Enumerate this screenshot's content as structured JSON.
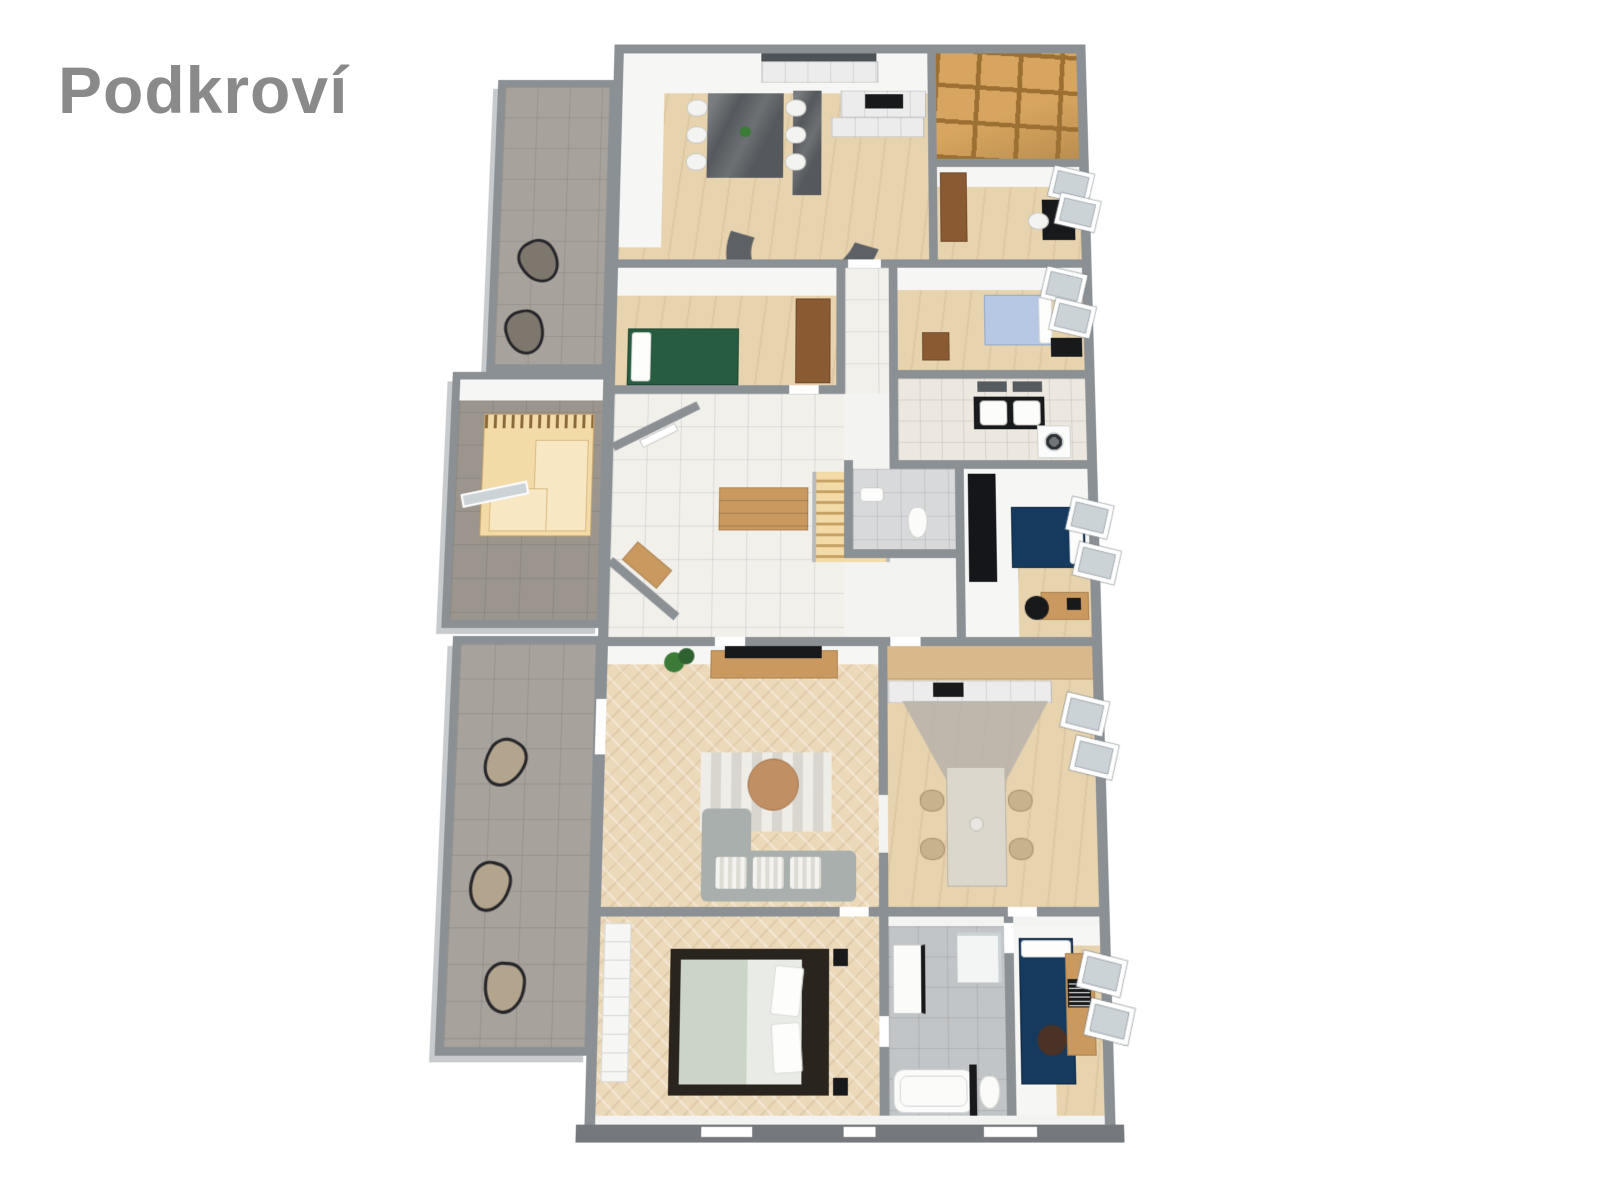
{
  "title": {
    "text": "Podkroví"
  },
  "canvas": {
    "width": 1599,
    "height": 1200,
    "background": "#ffffff"
  },
  "colors": {
    "white": "#ffffff",
    "titleGrey": "#8a8a8a",
    "wall": "#8b9094",
    "wallDark": "#75797d",
    "wallLight": "#c8cbcd",
    "wallFace": "#f6f6f4",
    "wood": "#e7d3ae",
    "herringbone": "#ecd9ba",
    "tileGrey": "#a7a29b",
    "tileWarm": "#9b958d",
    "tileWhite": "#f2f0eb",
    "tileBeige": "#ece7df",
    "tileBath": "#c2c5c7",
    "attic": "#d7a55f",
    "atticBeam": "#9c6f33",
    "stoneDark": "#55595d",
    "cabinet": "#ececec",
    "sofaDark": "#5d6165",
    "sofaGrey": "#a9afac",
    "bedGreen": "#275c41",
    "bedBlue": "#16395e",
    "bedLightBlue": "#b6c8e4",
    "mattress": "#e9ece6",
    "sage": "#cbd4c6",
    "bedFrameDark": "#2a241e",
    "furnWood": "#c9995f",
    "brownWood": "#8a5a33",
    "tanChair": "#c7b28c",
    "stairWood": "#f3dba8",
    "rugLight": "#efede8",
    "rugStripe": "#d9d6cf",
    "plant": "#3c7a38",
    "black": "#17191b",
    "glass": "#ccd3d7",
    "loungeDark": "#7d776e",
    "loungeTan": "#b2a48d",
    "travertine": "#dcd7cc"
  },
  "floorplan": {
    "type": "3d-floor-plan-render",
    "areas": [
      {
        "id": "upper-terrace",
        "floor": "grey-tile",
        "furniture": [
          "lounge-chair",
          "lounge-chair"
        ]
      },
      {
        "id": "dining-kitchen",
        "floor": "light-wood",
        "furniture": [
          "kitchen-cabinets",
          "cooktop",
          "dark-stone-island",
          "dining-table",
          "six-white-chairs",
          "curved-sofa"
        ]
      },
      {
        "id": "attic-storage",
        "floor": "exposed-wood-joists",
        "furniture": []
      },
      {
        "id": "study-bedroom",
        "floor": "light-wood",
        "furniture": [
          "wardrobe",
          "desk",
          "chair",
          "roof-window",
          "roof-window"
        ]
      },
      {
        "id": "green-bedroom",
        "floor": "light-wood",
        "furniture": [
          "double-bed-green",
          "wardrobe"
        ]
      },
      {
        "id": "hallway-stairs",
        "floor": "white-tile",
        "furniture": [
          "staircase",
          "chest-of-drawers",
          "entry-door",
          "shoe-cabinet"
        ]
      },
      {
        "id": "blue-bedroom-small",
        "floor": "light-wood",
        "furniture": [
          "bed-light-blue",
          "dresser",
          "desk",
          "roof-window",
          "roof-window"
        ]
      },
      {
        "id": "bathroom-upper",
        "floor": "beige-tile",
        "furniture": [
          "double-washbasin-vanity",
          "mirrors",
          "washing-machine"
        ]
      },
      {
        "id": "wc",
        "floor": "grey-tile",
        "furniture": [
          "toilet",
          "washbasin"
        ]
      },
      {
        "id": "blue-bedroom-mid",
        "floor": "white-low-ceiling",
        "furniture": [
          "double-bed-blue",
          "black-wardrobe",
          "desk",
          "chair",
          "laptop",
          "roof-window",
          "roof-window"
        ]
      },
      {
        "id": "sauna-room",
        "floor": "grey-tile",
        "furniture": [
          "sauna-cabin",
          "glass-door"
        ]
      },
      {
        "id": "living-room",
        "floor": "herringbone-wood",
        "furniture": [
          "tv-sideboard",
          "tv",
          "plant",
          "striped-rug",
          "round-coffee-table",
          "corner-sofa"
        ]
      },
      {
        "id": "kitchen-dining-second",
        "floor": "herringbone-wood",
        "furniture": [
          "wall-cabinets",
          "counter-with-cooktop",
          "dining-table",
          "four-chairs",
          "roof-window",
          "roof-window"
        ]
      },
      {
        "id": "master-bedroom",
        "floor": "herringbone-wood",
        "furniture": [
          "double-bed",
          "built-in-wardrobe",
          "nightstand",
          "nightstand"
        ]
      },
      {
        "id": "bathroom-lower",
        "floor": "grey-tile",
        "furniture": [
          "vanity",
          "shower",
          "bathtub",
          "toilet"
        ]
      },
      {
        "id": "blue-bedroom-lower",
        "floor": "wood-and-white",
        "furniture": [
          "bed-blue",
          "desk",
          "laptop",
          "pouf",
          "roof-window",
          "roof-window"
        ]
      },
      {
        "id": "lower-terrace",
        "floor": "grey-tile",
        "furniture": [
          "lounge-chair",
          "lounge-chair",
          "lounge-chair"
        ]
      }
    ]
  }
}
